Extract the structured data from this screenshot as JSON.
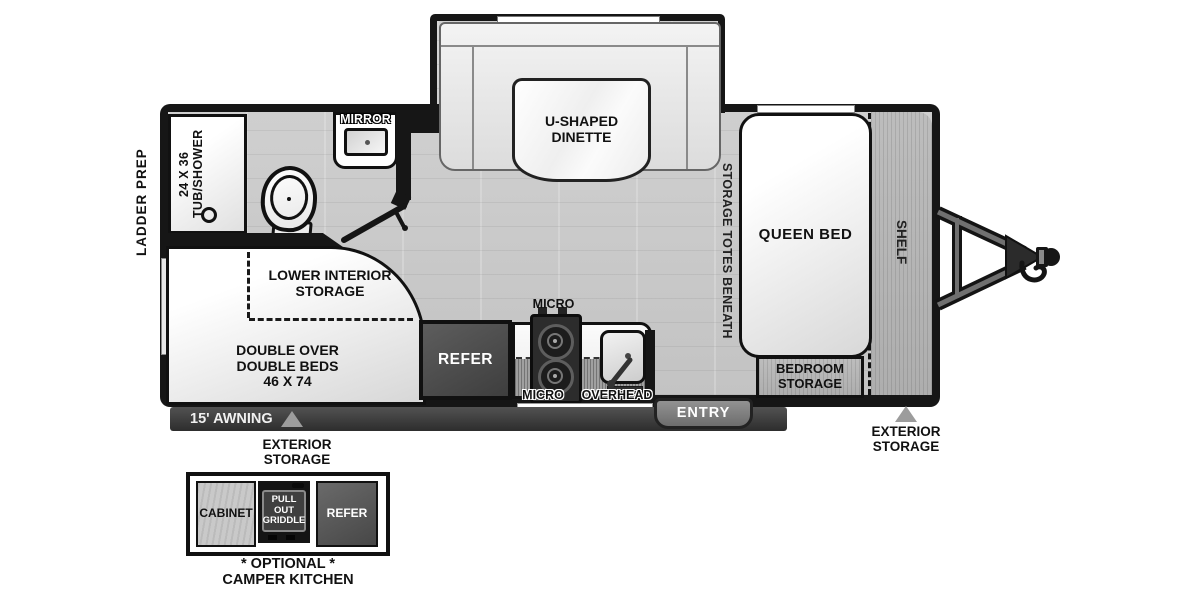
{
  "plan": {
    "exterior": {
      "ladder_prep": "LADDER PREP",
      "awning": "15' AWNING",
      "exterior_storage_left": "EXTERIOR\nSTORAGE",
      "exterior_storage_right": "EXTERIOR\nSTORAGE",
      "entry": "ENTRY"
    },
    "bathroom": {
      "tub_shower": "24 X 36\nTUB/SHOWER",
      "mirror": "MIRROR"
    },
    "dinette": {
      "table": "U-SHAPED\nDINETTE"
    },
    "bedroom": {
      "queen_bed": "QUEEN BED",
      "shelf": "SHELF",
      "storage_totes": "STORAGE TOTES BENEATH",
      "bedroom_storage": "BEDROOM\nSTORAGE"
    },
    "kitchen": {
      "refer": "REFER",
      "micro_upper": "MICRO",
      "micro_lower": "MICRO",
      "overhead": "OVERHEAD"
    },
    "bunkhouse": {
      "lower_interior_storage": "LOWER INTERIOR\nSTORAGE",
      "double_beds": "DOUBLE OVER\nDOUBLE BEDS\n46 X 74"
    },
    "camper_kitchen": {
      "cabinet": "CABINET",
      "pull_out_griddle": "PULL OUT\nGRIDDLE",
      "refer": "REFER",
      "caption": "* OPTIONAL *\nCAMPER KITCHEN"
    }
  },
  "colors": {
    "wall": "#161616",
    "floor": "#c9c9c9",
    "awning_bar": "#3a3a3a",
    "entry_door": "#7f7f7f",
    "marker_triangle": "#9c9c9c",
    "appliance_dark": "#474747",
    "furniture_white": "#ffffff"
  }
}
